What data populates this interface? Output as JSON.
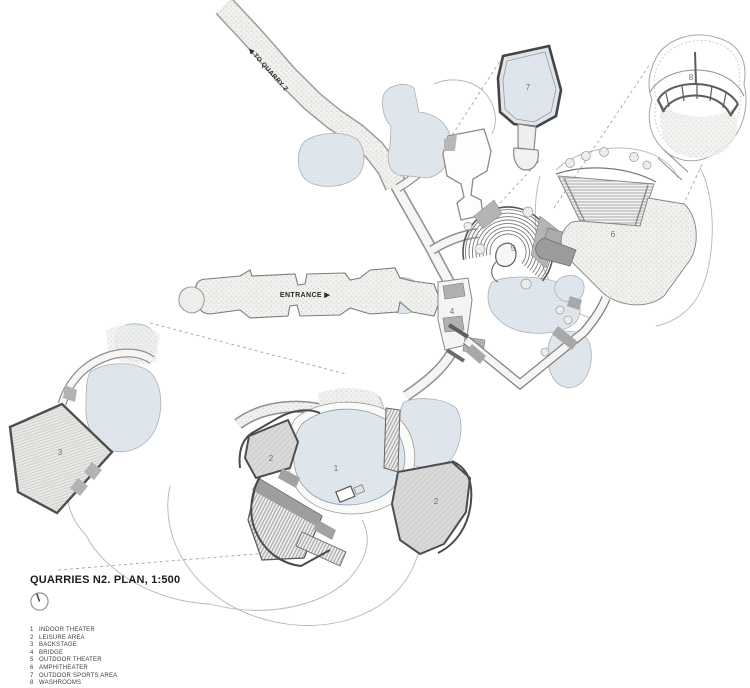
{
  "title_block": {
    "title": "QUARRIES N2. PLAN, 1:500"
  },
  "legend": {
    "items": [
      {
        "num": "1",
        "label": "INDOOR THEATER"
      },
      {
        "num": "2",
        "label": "LEISURE AREA"
      },
      {
        "num": "3",
        "label": "BACKSTAGE"
      },
      {
        "num": "4",
        "label": "BRIDGE"
      },
      {
        "num": "5",
        "label": "OUTDOOR THEATER"
      },
      {
        "num": "6",
        "label": "AMPHITHEATER"
      },
      {
        "num": "7",
        "label": "OUTDOOR SPORTS AREA"
      },
      {
        "num": "8",
        "label": "WASHROOMS"
      }
    ]
  },
  "plan": {
    "trail_label": "◀ TO QUARRY 2",
    "entrance_label": "ENTRANCE ▶",
    "markers": [
      {
        "num": "1",
        "area": "indoor-theater"
      },
      {
        "num": "2",
        "area": "leisure-area"
      },
      {
        "num": "3",
        "area": "backstage"
      },
      {
        "num": "4",
        "area": "bridge"
      },
      {
        "num": "5",
        "area": "outdoor-theater"
      },
      {
        "num": "6",
        "area": "amphitheater"
      },
      {
        "num": "7",
        "area": "outdoor-sports-area"
      },
      {
        "num": "8",
        "area": "washrooms"
      }
    ]
  },
  "colors": {
    "rock_fill": "#e1e7ee",
    "rock_stroke": "#a8b1b9",
    "ground_fill": "#f0f0ee",
    "leisure_fill": "#d9d9d7",
    "ramp_gray": "#9b9b9b",
    "outline_dark": "#4a4a4a",
    "outline_mid": "#8a8a8a",
    "outline_light": "#b3b3b3",
    "label_text": "#707070",
    "title_text": "#1c1c1c"
  }
}
